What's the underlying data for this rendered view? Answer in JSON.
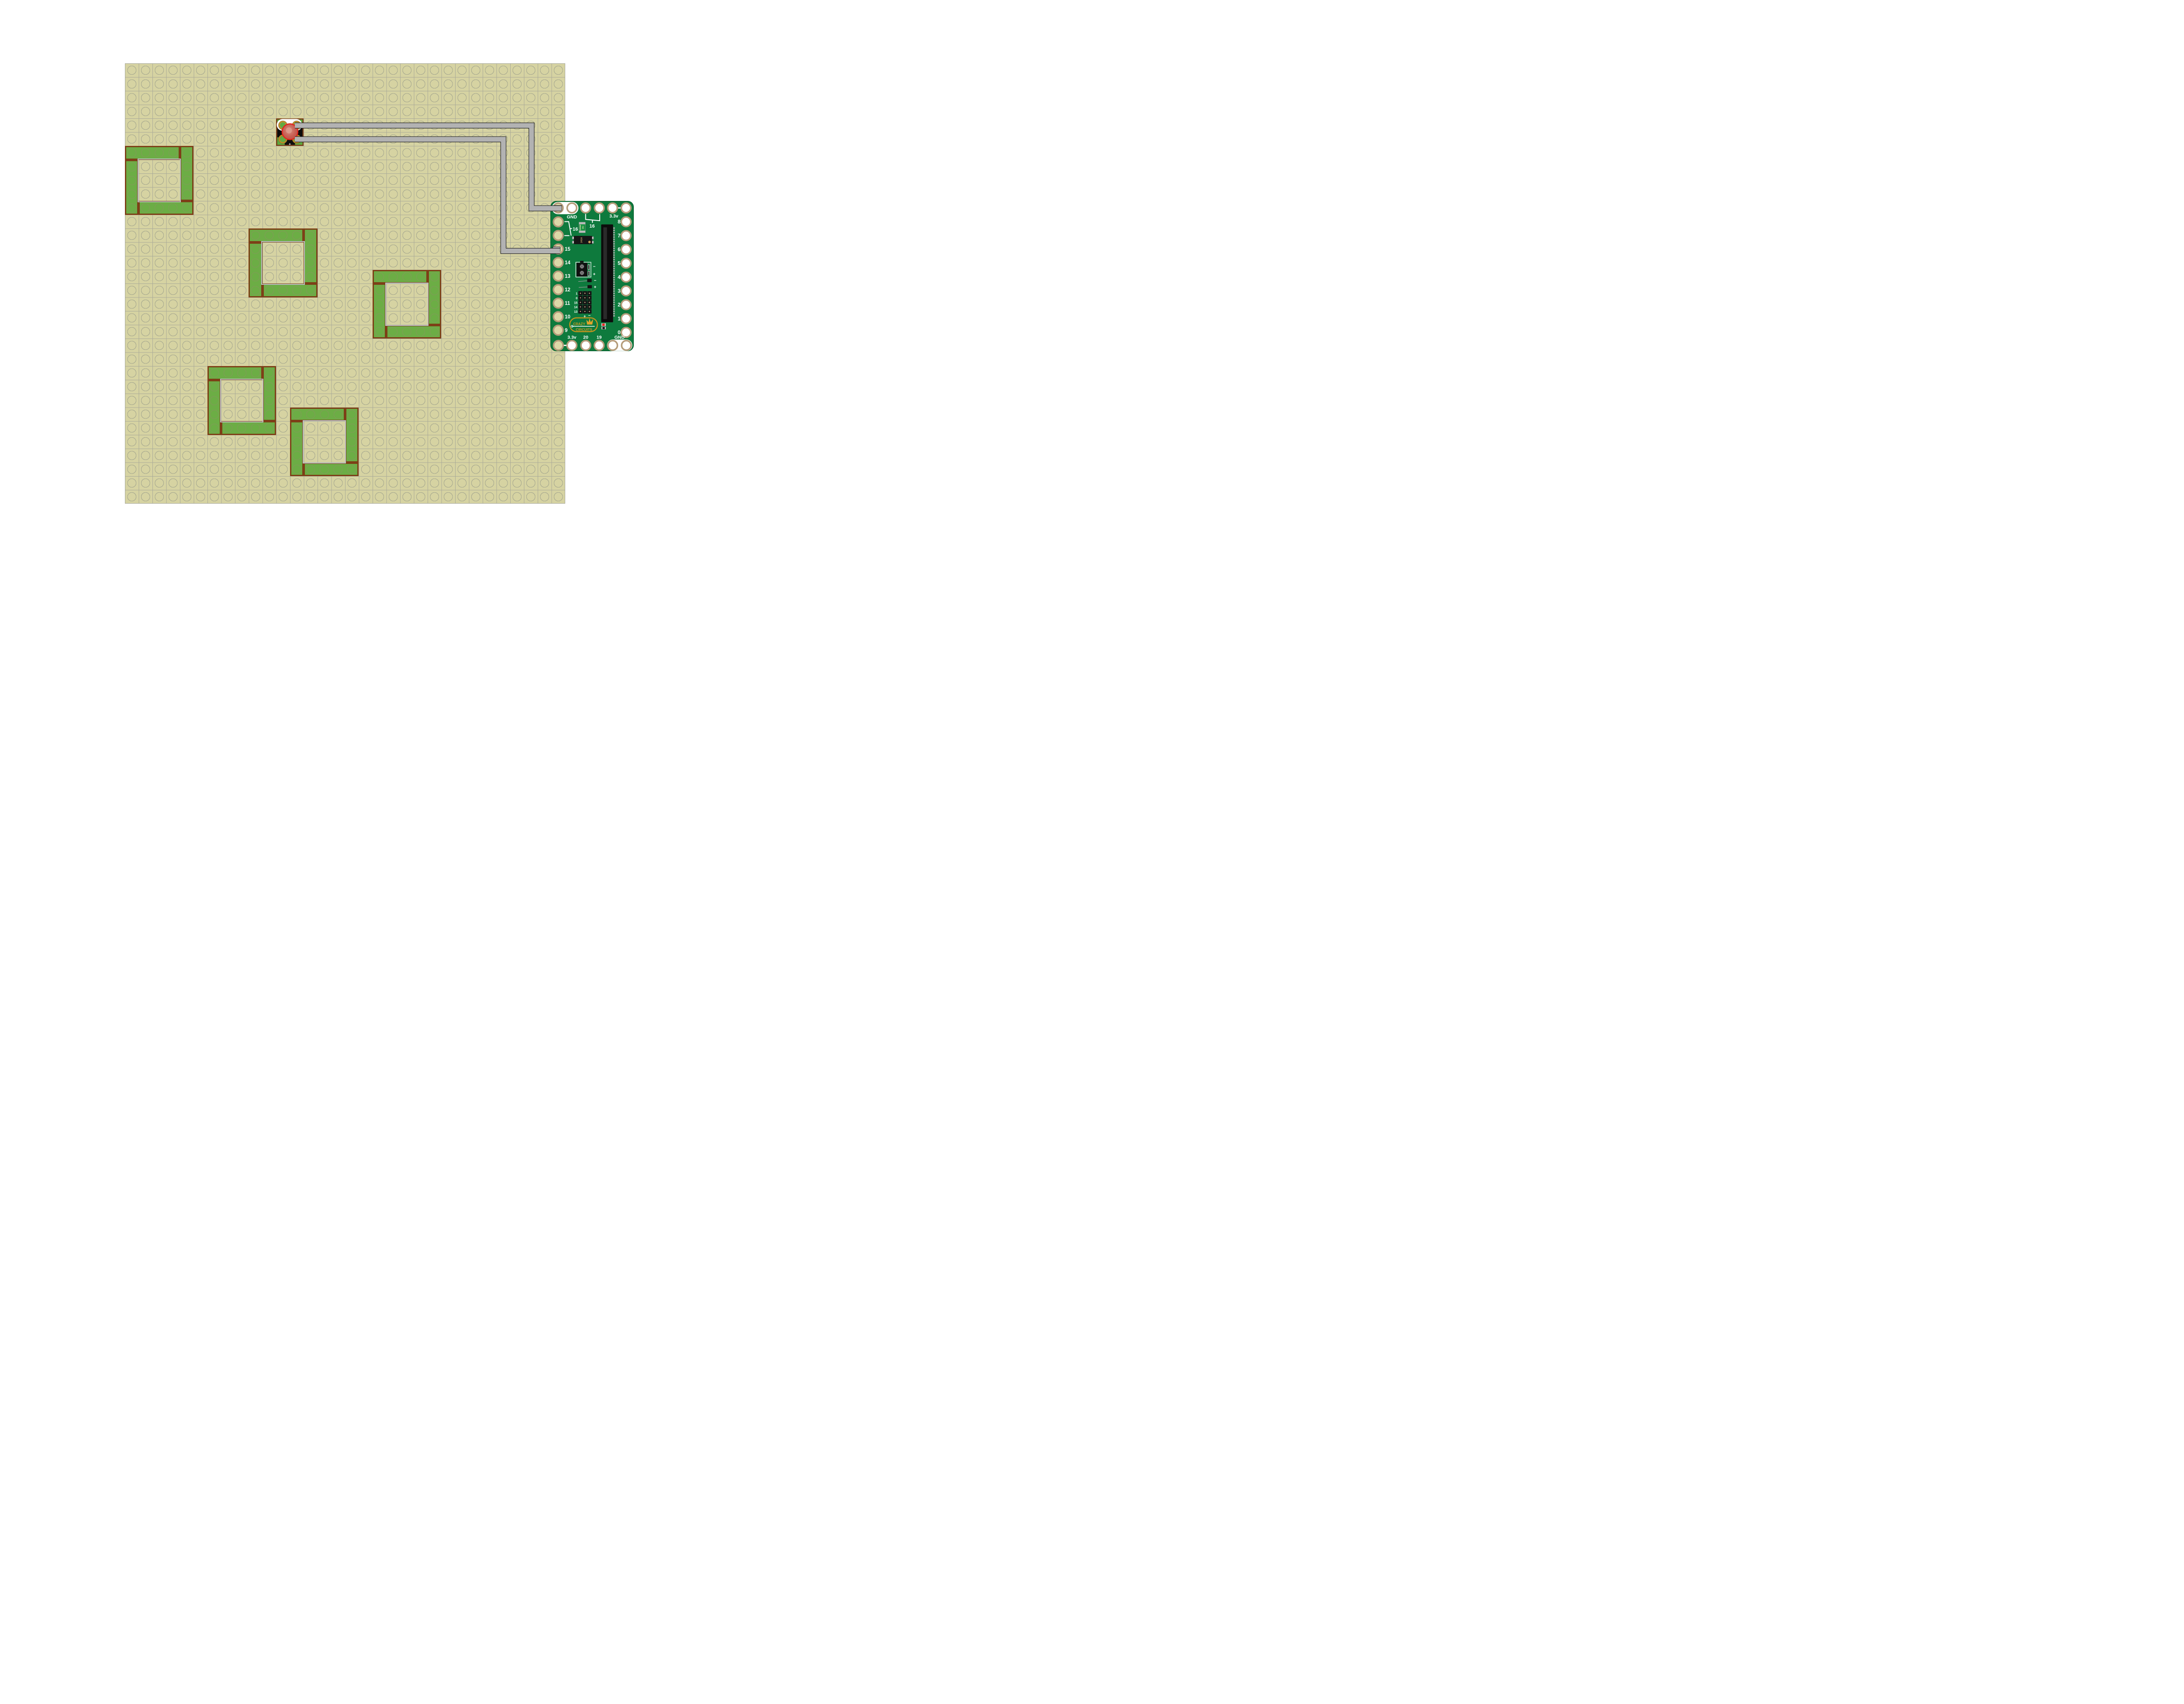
{
  "plate": {
    "cols": 32,
    "rows": 32
  },
  "squares": [
    [
      0,
      6
    ],
    [
      9,
      12
    ],
    [
      18,
      15
    ],
    [
      6,
      22
    ],
    [
      12,
      25
    ]
  ],
  "button": {
    "col": 11,
    "row": 4,
    "plus_label": "+"
  },
  "pcb": {
    "top": {
      "gnd": "GND",
      "v33": "3.3v",
      "bracket16": "16"
    },
    "left_bracket16": "16",
    "left_pins": [
      "15",
      "14",
      "13",
      "12",
      "11",
      "10",
      "9"
    ],
    "right_pins": [
      "8",
      "7",
      "6",
      "5",
      "4",
      "3",
      "2",
      "1",
      "0"
    ],
    "bottom": {
      "v33": "3.3v",
      "p20": "20",
      "p19": "19",
      "gnd": "GND"
    },
    "fuse": {
      "line1": "X200F",
      "line2": "16v"
    },
    "ic": "241A",
    "terminal": {
      "minus": "−",
      "plus": "+"
    },
    "probe": {
      "minus": "−",
      "plus": "+"
    },
    "header": {
      "rows": [
        "1",
        "0",
        "15",
        "14",
        "13"
      ],
      "plus": "+",
      "minus": "−"
    },
    "logo": {
      "top": "CRAZY",
      "bottom": "CIRCUITS"
    }
  },
  "colors": {
    "plate": "#d6d3a2",
    "brick_green": "#6cad45",
    "brick_border": "#7d3f17",
    "trace": "#b2b2b2",
    "pcb_green": "#0e7a3d",
    "pad_ring": "#b59c7a",
    "gold": "#c8941d",
    "button_red": "#c75f53",
    "hole_beige": "#dcd8a8"
  }
}
